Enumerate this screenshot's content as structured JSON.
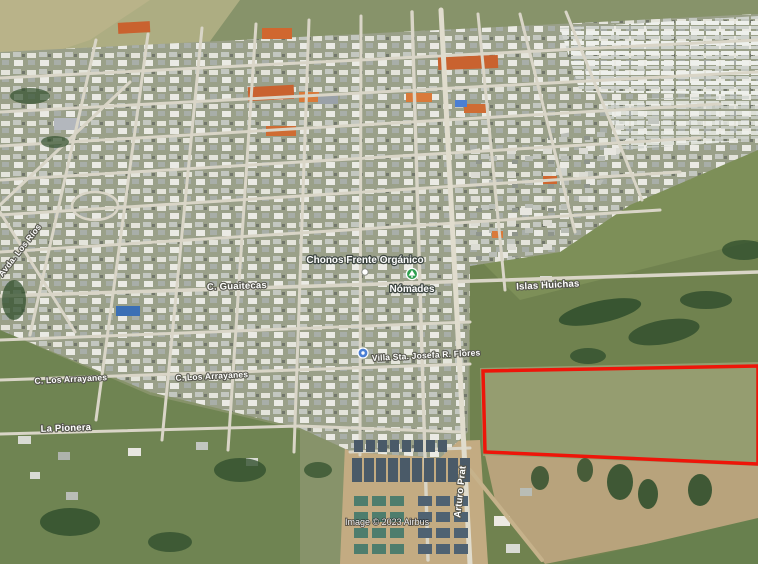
{
  "view": {
    "description": "Google Earth style 3D aerial satellite view of a small town with a land parcel outlined in red"
  },
  "attribution": {
    "text": "Image © 2023 Airbus"
  },
  "parcel": {
    "name": "highlighted land parcel",
    "outline_color": "#ee1509"
  },
  "markers": {
    "place1": {
      "label": "Chonos Frente Orgánico",
      "icon": "white-place-dot"
    },
    "place2": {
      "label": "Nómades",
      "icon": "green-park-marker",
      "icon_color": "#2e9e4f"
    },
    "place3": {
      "label": "Villa Sta. Josefa R. Flores",
      "icon": "blue-place-marker",
      "icon_color": "#4a7fd4"
    }
  },
  "streets": {
    "guaitecas": "C. Guaitecas",
    "islas": "Islas Huichas",
    "arrayanes_w": "C. Los Arrayanes",
    "arrayanes_e": "C. Los Arrayanes",
    "pionera": "La Pionera",
    "prat": "Arturo Prat",
    "avda": "Avda. Los Ríos"
  }
}
